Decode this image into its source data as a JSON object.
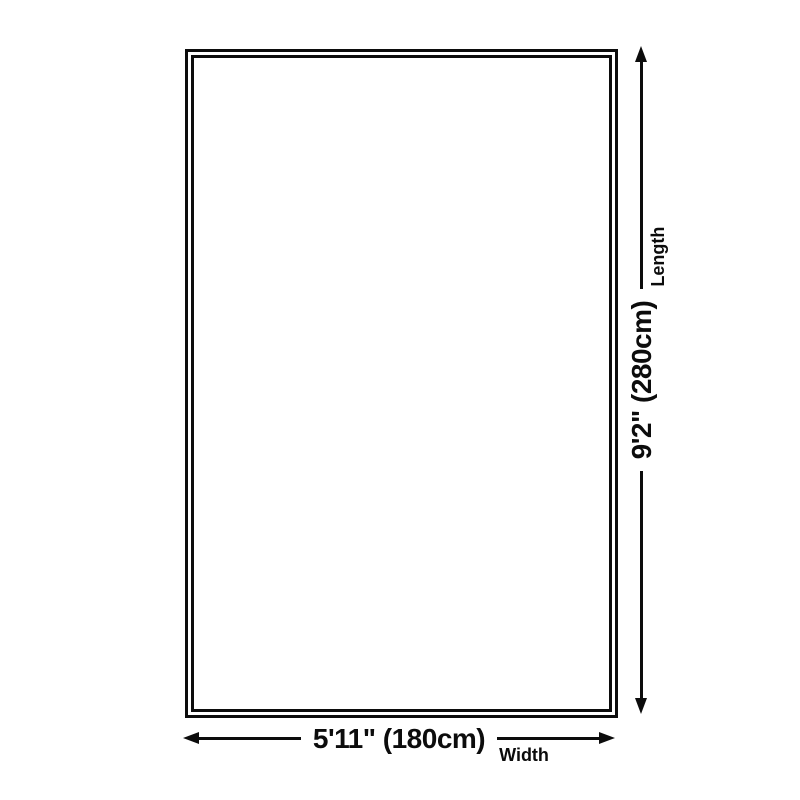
{
  "diagram": {
    "name": "rug-size-diagram",
    "background": "#ffffff",
    "line_color": "#0c0c0c",
    "rug": {
      "shape": "rectangle",
      "border_style": "double"
    },
    "length_dim": {
      "value": "9'2\" (280cm)",
      "label": "Length"
    },
    "width_dim": {
      "value": "5'11\" (180cm)",
      "label": "Width"
    }
  }
}
